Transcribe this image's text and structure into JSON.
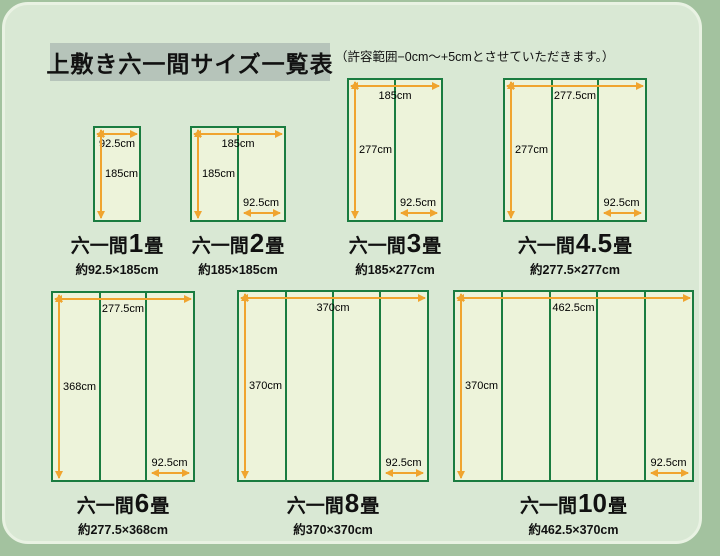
{
  "header": {
    "title": "上敷き六一間サイズ一覧表",
    "note": "（許容範囲−0cm〜+5cmとさせていただきます。）"
  },
  "colors": {
    "outer_bg": "#a3c29f",
    "card_bg": "#d9e8d4",
    "card_rim": "#e9f2e3",
    "title_bg": "#b6c4ba",
    "mat_fill": "#edf3da",
    "mat_border": "#1a7c40",
    "arrow": "#f0a42f",
    "text": "#111111"
  },
  "diagrams": [
    {
      "name_prefix": "六一間",
      "name_number": "1",
      "name_suffix": "畳",
      "size_label": "約92.5×185cm",
      "width_cm": 92.5,
      "height_cm": 185,
      "mat_count": 1,
      "width_label": "92.5cm",
      "height_label": "185cm",
      "mat_width_label": ""
    },
    {
      "name_prefix": "六一間",
      "name_number": "2",
      "name_suffix": "畳",
      "size_label": "約185×185cm",
      "width_cm": 185,
      "height_cm": 185,
      "mat_count": 2,
      "width_label": "185cm",
      "height_label": "185cm",
      "mat_width_label": "92.5cm"
    },
    {
      "name_prefix": "六一間",
      "name_number": "3",
      "name_suffix": "畳",
      "size_label": "約185×277cm",
      "width_cm": 185,
      "height_cm": 277,
      "mat_count": 2,
      "width_label": "185cm",
      "height_label": "277cm",
      "mat_width_label": "92.5cm"
    },
    {
      "name_prefix": "六一間",
      "name_number": "4.5",
      "name_suffix": "畳",
      "size_label": "約277.5×277cm",
      "width_cm": 277.5,
      "height_cm": 277,
      "mat_count": 3,
      "width_label": "277.5cm",
      "height_label": "277cm",
      "mat_width_label": "92.5cm"
    },
    {
      "name_prefix": "六一間",
      "name_number": "6",
      "name_suffix": "畳",
      "size_label": "約277.5×368cm",
      "width_cm": 277.5,
      "height_cm": 368,
      "mat_count": 3,
      "width_label": "277.5cm",
      "height_label": "368cm",
      "mat_width_label": "92.5cm"
    },
    {
      "name_prefix": "六一間",
      "name_number": "8",
      "name_suffix": "畳",
      "size_label": "約370×370cm",
      "width_cm": 370,
      "height_cm": 370,
      "mat_count": 4,
      "width_label": "370cm",
      "height_label": "370cm",
      "mat_width_label": "92.5cm"
    },
    {
      "name_prefix": "六一間",
      "name_number": "10",
      "name_suffix": "畳",
      "size_label": "約462.5×370cm",
      "width_cm": 462.5,
      "height_cm": 370,
      "mat_count": 5,
      "width_label": "462.5cm",
      "height_label": "370cm",
      "mat_width_label": "92.5cm"
    }
  ]
}
